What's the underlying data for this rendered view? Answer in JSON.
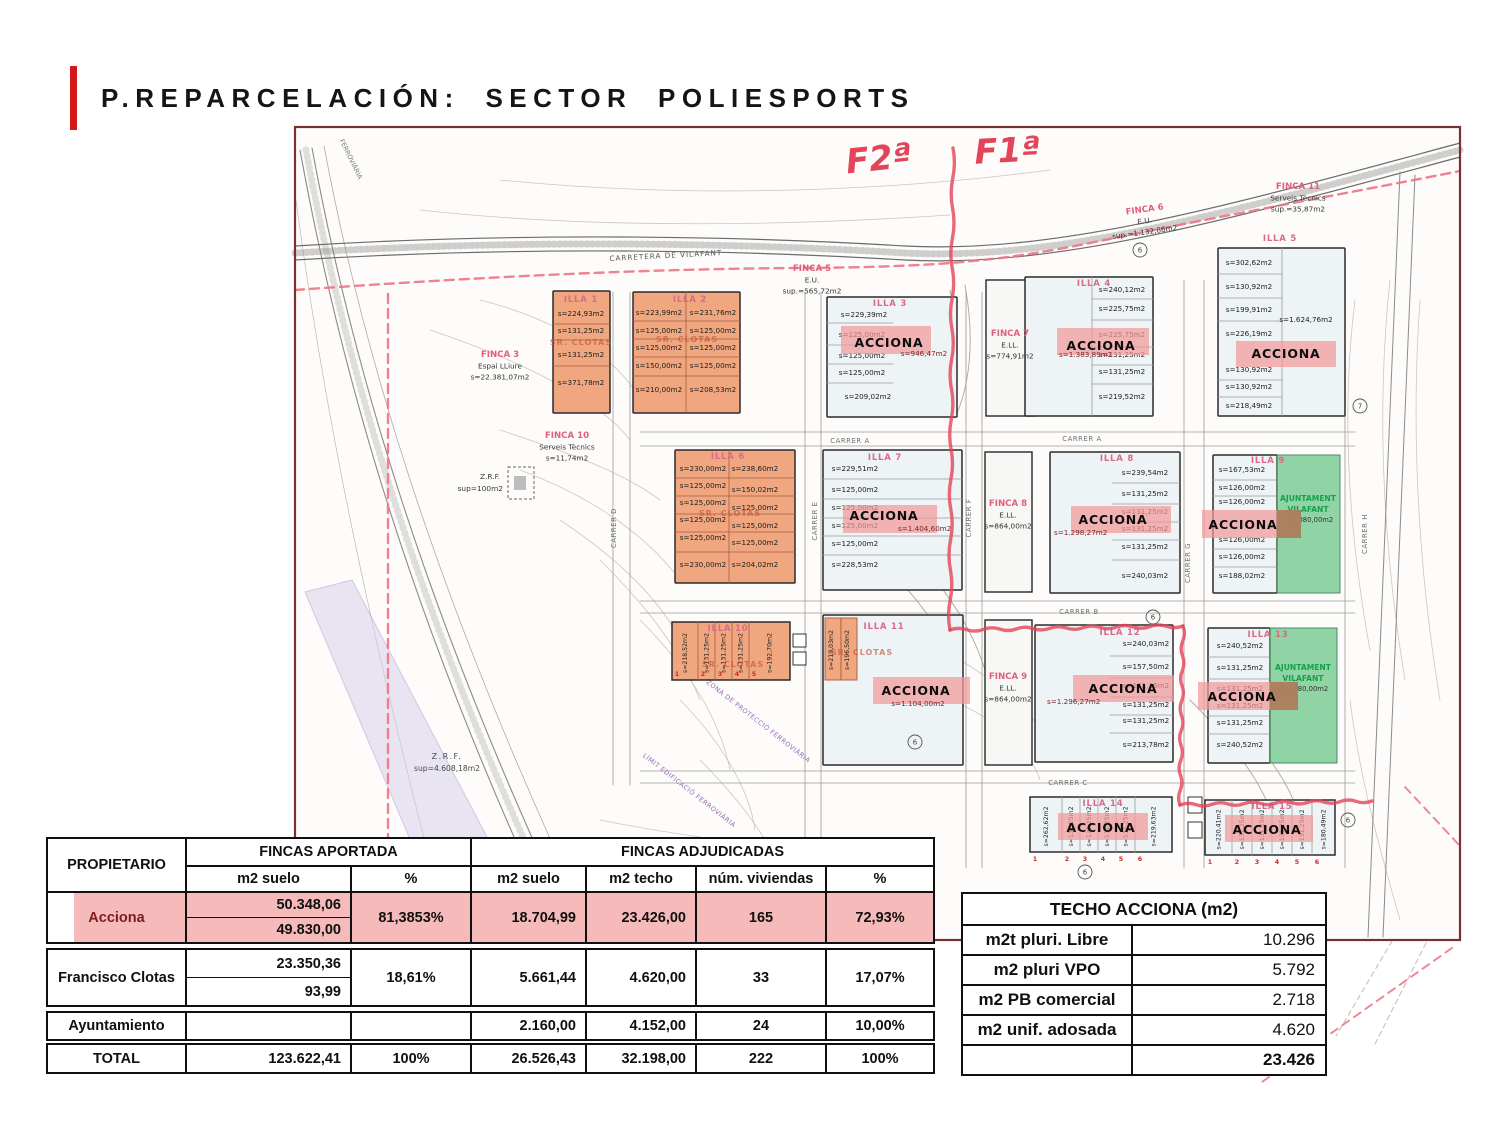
{
  "slide": {
    "title": "P.REPARCELACIÓN: SECTOR POLIESPORTS",
    "accent_color": "#d41717"
  },
  "map": {
    "handwritten": {
      "f2": "F2ª",
      "f1": "F1ª"
    },
    "road_label": "CARRETERA DE VILAFANT",
    "rail_label": "FERROVIÀRIA",
    "zone_label": "ZONA DE PROTECCIÓ FERROVIÀRIA",
    "limit_label": "LÍMIT EDIFICACIÓ FERROVIÀRIA",
    "labels": {
      "acciona": "ACCIONA",
      "clotas": "SR. CLOTAS",
      "ajuntament1": "AJUNTAMENT",
      "ajuntament2": "VILAFANT"
    },
    "streets": {
      "a": "CARRER A",
      "b": "CARRER B",
      "c": "CARRER C",
      "d": "CARRER D",
      "e": "CARRER E",
      "f": "CARRER F",
      "g": "CARRER G",
      "h": "CARRER H"
    },
    "fincas": [
      {
        "name": "FINCA 3",
        "sub": "Espai LLiure",
        "area": "s=22.381,07m2"
      },
      {
        "name": "FINCA 5",
        "sub": "E.U.",
        "area": "sup.=565,72m2"
      },
      {
        "name": "FINCA 6",
        "sub": "E.U.",
        "area": "sup.=1.132,86m2"
      },
      {
        "name": "FINCA 7",
        "sub": "E.LL.",
        "area": "s=774,91m2"
      },
      {
        "name": "FINCA 8",
        "sub": "E.LL.",
        "area": "s=864,00m2"
      },
      {
        "name": "FINCA 9",
        "sub": "E.LL.",
        "area": "s=864,00m2"
      },
      {
        "name": "FINCA 10",
        "sub": "Serveis Tècnics",
        "area": "s=11,74m2"
      },
      {
        "name": "FINCA 11",
        "sub": "Serveis Tècnics",
        "area": "sup.=35,87m2"
      }
    ],
    "zrf": [
      {
        "name": "Z.R.F.",
        "area": "sup=100m2"
      },
      {
        "name": "Z.R.F.",
        "area": "sup=4.608,18m2"
      }
    ],
    "circled": [
      "6",
      "7"
    ],
    "strip_numbers": [
      "1",
      "2",
      "3",
      "4",
      "5",
      "6"
    ],
    "illas": [
      {
        "name": "ILLA 1",
        "parcels": [
          "s=224,93m2",
          "s=131,25m2",
          "s=131,25m2",
          "s=371,78m2"
        ]
      },
      {
        "name": "ILLA 2",
        "parcels": [
          "s=223,99m2",
          "s=231,76m2",
          "s=125,00m2",
          "s=125,00m2",
          "s=125,00m2",
          "s=125,00m2",
          "s=150,00m2",
          "s=125,00m2",
          "s=210,00m2",
          "s=208,53m2"
        ]
      },
      {
        "name": "ILLA 3",
        "acciona_area": "s=946,47m2",
        "parcels": [
          "s=229,39m2",
          "s=125,00m2",
          "s=125,00m2",
          "s=125,00m2",
          "s=209,02m2"
        ]
      },
      {
        "name": "ILLA 4",
        "acciona_area": "s=1.383,89m2",
        "parcels": [
          "s=240,12m2",
          "s=225,75m2",
          "s=225,75m2",
          "s=131,25m2",
          "s=131,25m2",
          "s=219,52m2"
        ]
      },
      {
        "name": "ILLA 5",
        "acciona_area": "s=1.624,76m2",
        "parcels": [
          "s=302,62m2",
          "s=130,92m2",
          "s=199,91m2",
          "s=226,19m2",
          "s=130,92m2",
          "s=130,92m2",
          "s=218,49m2"
        ]
      },
      {
        "name": "ILLA 6",
        "parcels": [
          "s=230,00m2",
          "s=238,60m2",
          "s=125,00m2",
          "s=150,02m2",
          "s=125,00m2",
          "s=125,00m2",
          "s=125,00m2",
          "s=125,00m2",
          "s=125,00m2",
          "s=125,00m2",
          "s=230,00m2",
          "s=204,02m2"
        ]
      },
      {
        "name": "ILLA 7",
        "acciona_area": "s=1.404,60m2",
        "parcels": [
          "s=229,51m2",
          "s=125,00m2",
          "s=125,00m2",
          "s=125,00m2",
          "s=125,00m2",
          "s=228,53m2"
        ]
      },
      {
        "name": "ILLA 8",
        "acciona_area": "s=1.298,27m2",
        "parcels": [
          "s=239,54m2",
          "s=131,25m2",
          "s=131,25m2",
          "s=131,25m2",
          "s=131,25m2",
          "s=240,03m2"
        ]
      },
      {
        "name": "ILLA 9",
        "ajuntament_area": "s=1.080,00m2",
        "parcels": [
          "s=167,53m2",
          "s=126,00m2",
          "s=126,00m2",
          "s=126,00m2",
          "s=126,00m2",
          "s=188,02m2"
        ]
      },
      {
        "name": "ILLA 10",
        "parcels": [
          "s=218,52m2",
          "s=131,25m2",
          "s=131,25m2",
          "s=131,25m2",
          "s=192,70m2"
        ]
      },
      {
        "name": "ILLA 11",
        "acciona_area": "s=1.104,00m2",
        "parcels": [
          "s=219,03m2",
          "s=196,50m2"
        ]
      },
      {
        "name": "ILLA 12",
        "acciona_area": "s=1.296,27m2",
        "parcels": [
          "s=240,03m2",
          "s=157,50m2",
          "s=131,25m2",
          "s=131,25m2",
          "s=131,25m2",
          "s=213,78m2"
        ]
      },
      {
        "name": "ILLA 13",
        "ajuntament_area": "s=1.080,00m2",
        "parcels": [
          "s=240,52m2",
          "s=131,25m2",
          "s=131,25m2",
          "s=131,25m2",
          "s=131,25m2",
          "s=240,52m2"
        ]
      },
      {
        "name": "ILLA 14",
        "parcels": [
          "s=262,62m2",
          "s=131,25m2",
          "s=131,25m2",
          "s=131,25m2",
          "s=131,25m2",
          "s=219,63m2"
        ]
      },
      {
        "name": "ILLA 15",
        "parcels": [
          "s=220,41m2",
          "s=131,25m2",
          "s=131,25m2",
          "s=131,25m2",
          "s=131,25m2",
          "s=180,49m2"
        ]
      }
    ]
  },
  "allocation_table": {
    "highlight_color": "#f6baba",
    "header": {
      "propietario": "PROPIETARIO",
      "fincas_aportada": "FINCAS APORTADA",
      "fincas_adjudicadas": "FINCAS ADJUDICADAS",
      "m2_suelo_aportada": "m2 suelo",
      "pct_aportada": "%",
      "m2_suelo_adj": "m2 suelo",
      "m2_techo": "m2 techo",
      "num_viviendas": "núm. viviendas",
      "pct_adj": "%"
    },
    "rows": [
      {
        "name": "Acciona",
        "suelo_top": "50.348,06",
        "suelo_bottom": "49.830,00",
        "pct": "81,3853%",
        "suelo_adj": "18.704,99",
        "techo": "23.426,00",
        "viviendas": "165",
        "pct_adj": "72,93%"
      },
      {
        "name": "Francisco Clotas",
        "suelo_top": "23.350,36",
        "suelo_bottom": "93,99",
        "pct": "18,61%",
        "suelo_adj": "5.661,44",
        "techo": "4.620,00",
        "viviendas": "33",
        "pct_adj": "17,07%"
      },
      {
        "name": "Ayuntamiento",
        "suelo": "",
        "pct": "",
        "suelo_adj": "2.160,00",
        "techo": "4.152,00",
        "viviendas": "24",
        "pct_adj": "10,00%"
      },
      {
        "name": "TOTAL",
        "suelo": "123.622,41",
        "pct": "100%",
        "suelo_adj": "26.526,43",
        "techo": "32.198,00",
        "viviendas": "222",
        "pct_adj": "100%"
      }
    ]
  },
  "techo_table": {
    "title": "TECHO ACCIONA (m2)",
    "rows": [
      {
        "label": "m2t pluri. Libre",
        "value": "10.296"
      },
      {
        "label": "m2 pluri VPO",
        "value": "5.792"
      },
      {
        "label": "m2 PB comercial",
        "value": "2.718"
      },
      {
        "label": "m2 unif. adosada",
        "value": "4.620"
      },
      {
        "label": "",
        "value": "23.426"
      }
    ]
  }
}
